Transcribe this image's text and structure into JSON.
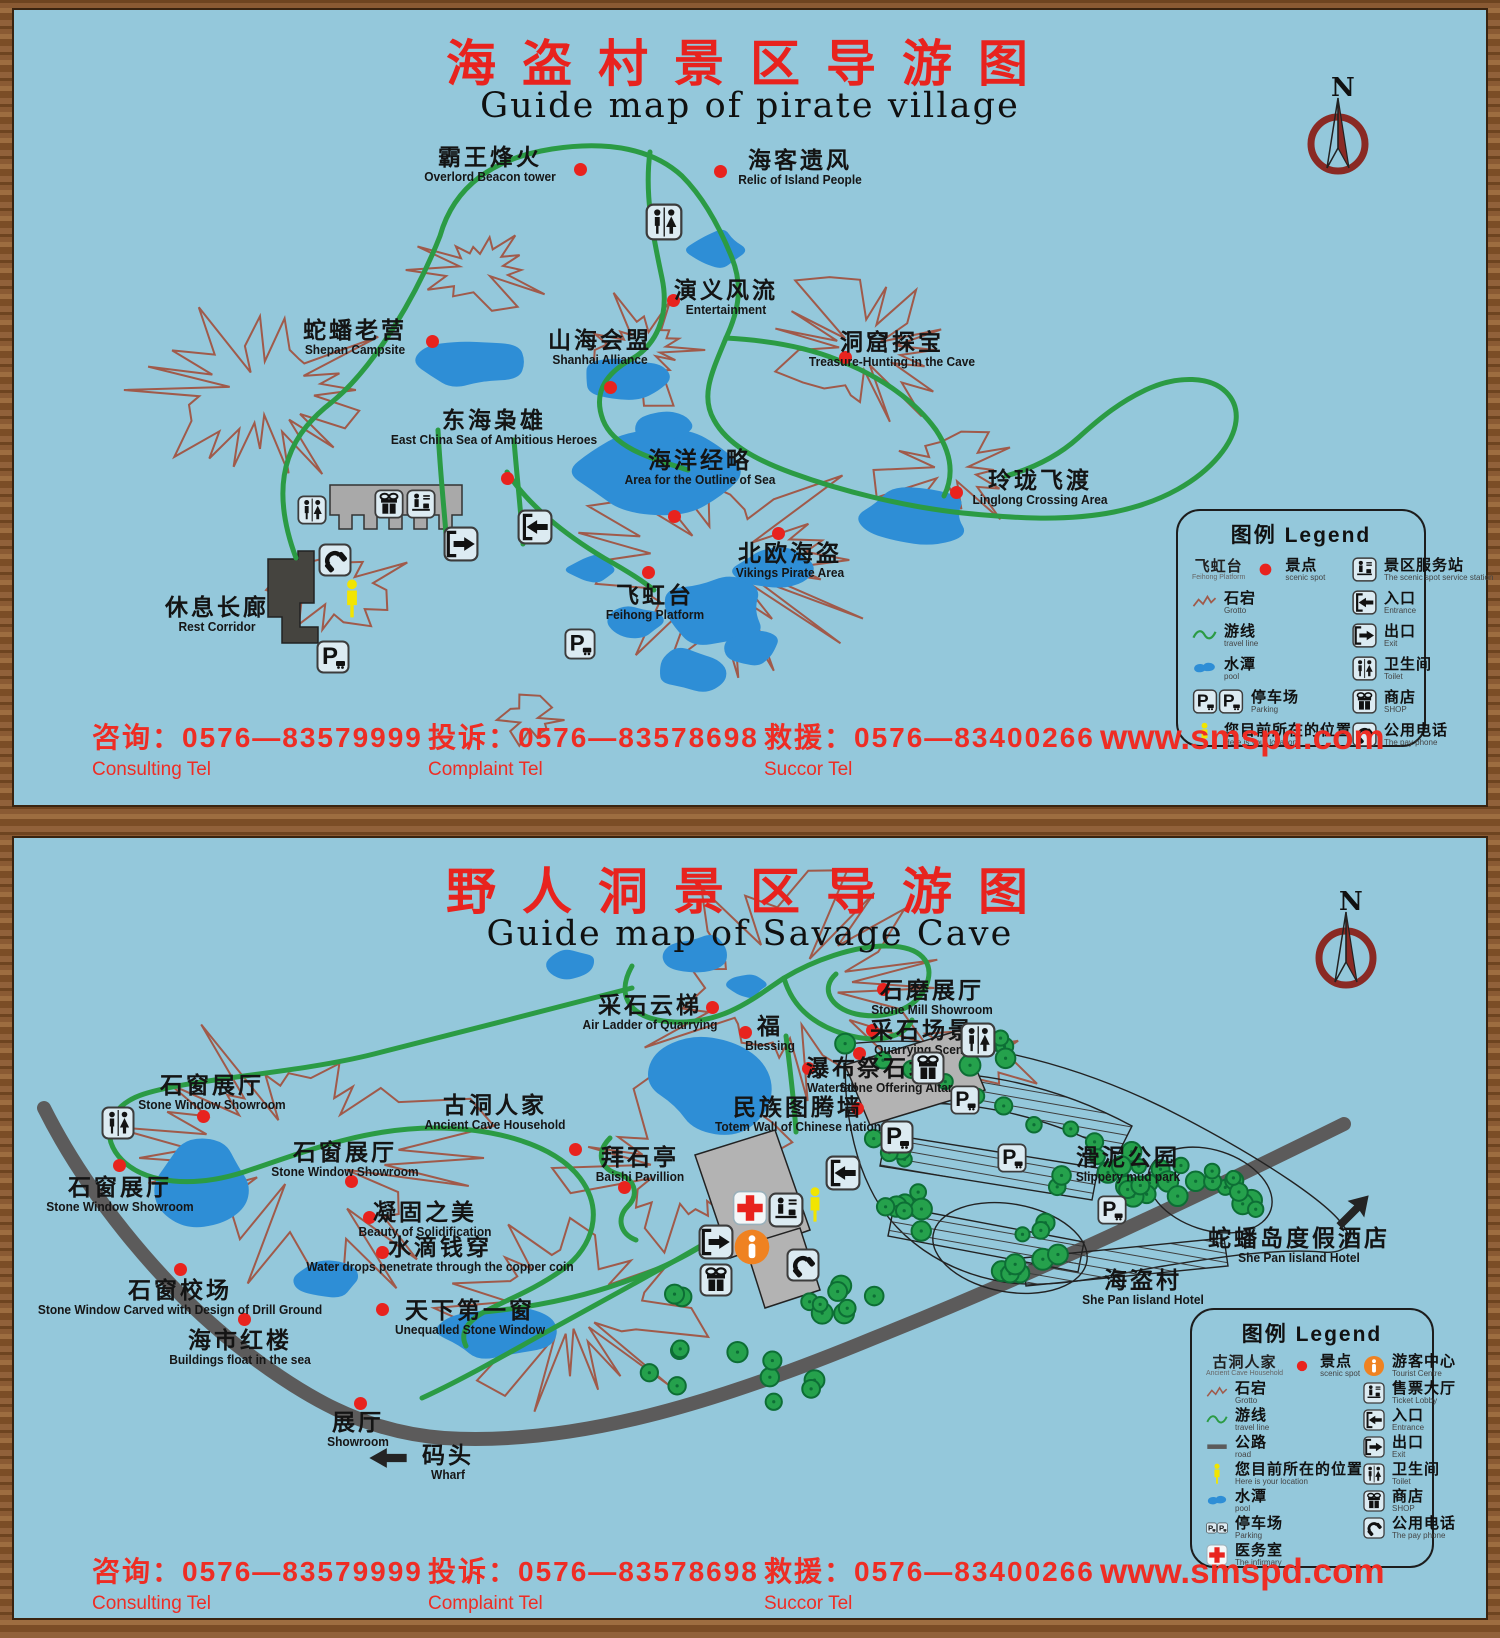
{
  "shared": {
    "compass_label": "N",
    "legend_title": "图例 Legend",
    "website": "www.smspd.com",
    "footer": {
      "consulting_cn": "咨询：0576—83579999",
      "consulting_en": "Consulting Tel",
      "complaint_cn": "投诉：0576—83578698",
      "complaint_en": "Complaint Tel",
      "succor_cn": "救援：0576—83400266",
      "succor_en": "Succor Tel"
    }
  },
  "panel1": {
    "title_cn": "海盗村景区导游图",
    "title_en": "Guide map of pirate village",
    "spots": [
      {
        "cn": "霸王烽火",
        "en": "Overlord Beacon tower",
        "x": 476,
        "y": 135,
        "dot": [
          566,
          159
        ]
      },
      {
        "cn": "海客遗风",
        "en": "Relic of Island People",
        "x": 786,
        "y": 138,
        "dot": [
          706,
          161
        ]
      },
      {
        "cn": "演义风流",
        "en": "Entertainment",
        "x": 712,
        "y": 268,
        "dot": [
          659,
          290
        ]
      },
      {
        "cn": "蛇蟠老营",
        "en": "Shepan Campsite",
        "x": 341,
        "y": 308,
        "dot": [
          418,
          331
        ]
      },
      {
        "cn": "山海会盟",
        "en": "Shanhai Alliance",
        "x": 586,
        "y": 318,
        "dot": [
          596,
          377
        ]
      },
      {
        "cn": "洞窟探宝",
        "en": "Treasure-Hunting in the Cave",
        "x": 878,
        "y": 320,
        "dot": [
          831,
          347
        ]
      },
      {
        "cn": "东海枭雄",
        "en": "East China Sea of Ambitious Heroes",
        "x": 480,
        "y": 398,
        "dot": [
          493,
          468
        ]
      },
      {
        "cn": "海洋经略",
        "en": "Area for the Outline of Sea",
        "x": 686,
        "y": 438,
        "dot": [
          660,
          506
        ]
      },
      {
        "cn": "北欧海盗",
        "en": "Vikings Pirate Area",
        "x": 776,
        "y": 531,
        "dot": [
          764,
          523
        ]
      },
      {
        "cn": "玲珑飞渡",
        "en": "Linglong Crossing Area",
        "x": 1026,
        "y": 458,
        "dot": [
          942,
          482
        ]
      },
      {
        "cn": "飞虹台",
        "en": "Feihong Platform",
        "x": 641,
        "y": 573,
        "dot": [
          634,
          562
        ]
      },
      {
        "cn": "休息长廊",
        "en": "Rest Corridor",
        "x": 203,
        "y": 585,
        "dot": null
      }
    ],
    "map_icons": [
      {
        "icon": "toilet",
        "x": 650,
        "y": 212,
        "s": 38
      },
      {
        "icon": "toilet",
        "x": 298,
        "y": 500,
        "s": 30
      },
      {
        "icon": "shop",
        "x": 375,
        "y": 494,
        "s": 30
      },
      {
        "icon": "service-station",
        "x": 407,
        "y": 494,
        "s": 30
      },
      {
        "icon": "phone",
        "x": 321,
        "y": 550,
        "s": 34
      },
      {
        "icon": "location",
        "x": 338,
        "y": 589,
        "s": 22,
        "h": 42
      },
      {
        "icon": "parking",
        "x": 319,
        "y": 647,
        "s": 34
      },
      {
        "icon": "parking",
        "x": 566,
        "y": 634,
        "s": 32
      },
      {
        "icon": "exit",
        "x": 447,
        "y": 534,
        "s": 36
      },
      {
        "icon": "entrance",
        "x": 521,
        "y": 517,
        "s": 36
      }
    ],
    "legend": {
      "left": [
        {
          "icon": "scenic-spot",
          "cn": "景点",
          "en": "scenic spot",
          "sample_cn": "飞虹台",
          "sample_en": "Feihong Platform"
        },
        {
          "icon": "grotto-line",
          "cn": "石宕",
          "en": "Grotto"
        },
        {
          "icon": "travel-line",
          "cn": "游线",
          "en": "travel line"
        },
        {
          "icon": "pool",
          "cn": "水潭",
          "en": "pool"
        },
        {
          "icon": "parking",
          "cn": "停车场",
          "en": "Parking",
          "double": true
        },
        {
          "icon": "location",
          "cn": "您目前所在的位置",
          "en": "Here is your location"
        }
      ],
      "right": [
        {
          "icon": "service-station",
          "cn": "景区服务站",
          "en": "The scenic spot service station"
        },
        {
          "icon": "entrance",
          "cn": "入口",
          "en": "Entrance"
        },
        {
          "icon": "exit",
          "cn": "出口",
          "en": "Exit"
        },
        {
          "icon": "toilet",
          "cn": "卫生间",
          "en": "Toilet"
        },
        {
          "icon": "shop",
          "cn": "商店",
          "en": "SHOP"
        },
        {
          "icon": "phone",
          "cn": "公用电话",
          "en": "The pay phone"
        }
      ]
    }
  },
  "panel2": {
    "title_cn": "野人洞景区导游图",
    "title_en": "Guide map of Savage Cave",
    "spots": [
      {
        "cn": "采石云梯",
        "en": "Air Ladder of Quarrying",
        "x": 636,
        "y": 155,
        "dot": [
          698,
          169
        ]
      },
      {
        "cn": "福",
        "en": "Blessing",
        "x": 756,
        "y": 176,
        "dot": [
          731,
          194
        ]
      },
      {
        "cn": "石磨展厅",
        "en": "Stone Mill Showroom",
        "x": 918,
        "y": 140,
        "dot": [
          869,
          151
        ]
      },
      {
        "cn": "采石场景",
        "en": "Quarrying Scene",
        "x": 908,
        "y": 180,
        "dot": [
          858,
          192
        ]
      },
      {
        "cn": "瀑布",
        "en": "Waterfall",
        "x": 818,
        "y": 218,
        "dot": [
          794,
          230
        ]
      },
      {
        "cn": "祭石坛",
        "en": "Stone Offering Altar",
        "x": 882,
        "y": 218,
        "dot": [
          845,
          215
        ]
      },
      {
        "cn": "民族图腾墙",
        "en": "Totem Wall of Chinese nation",
        "x": 784,
        "y": 257,
        "dot": [
          843,
          270
        ]
      },
      {
        "cn": "古洞人家",
        "en": "Ancient Cave Household",
        "x": 481,
        "y": 255,
        "dot": [
          561,
          311
        ]
      },
      {
        "cn": "拜石亭",
        "en": "Baishi Pavillion",
        "x": 626,
        "y": 307,
        "dot": [
          610,
          349
        ]
      },
      {
        "cn": "石窗展厅",
        "en": "Stone Window Showroom",
        "x": 198,
        "y": 235,
        "dot": [
          189,
          278
        ]
      },
      {
        "cn": "石窗展厅",
        "en": "Stone Window Showroom",
        "x": 331,
        "y": 302,
        "dot": [
          337,
          343
        ]
      },
      {
        "cn": "石窗展厅",
        "en": "Stone Window Showroom",
        "x": 106,
        "y": 337,
        "dot": [
          105,
          327
        ]
      },
      {
        "cn": "凝固之美",
        "en": "Beauty of Solidification",
        "x": 411,
        "y": 362,
        "dot": [
          355,
          379
        ]
      },
      {
        "cn": "水滴钱穿",
        "en": "Water drops penetrate through the copper coin",
        "x": 426,
        "y": 397,
        "dot": [
          368,
          414
        ]
      },
      {
        "cn": "石窗校场",
        "en": "Stone Window Carved with Design of Drill Ground",
        "x": 166,
        "y": 440,
        "dot": [
          166,
          431
        ]
      },
      {
        "cn": "海市红楼",
        "en": "Buildings float in the sea",
        "x": 226,
        "y": 490,
        "dot": [
          230,
          481
        ]
      },
      {
        "cn": "天下第一窗",
        "en": "Unequalled Stone Window",
        "x": 456,
        "y": 460,
        "dot": [
          368,
          471
        ]
      },
      {
        "cn": "展厅",
        "en": "Showroom",
        "x": 344,
        "y": 572,
        "dot": [
          346,
          565
        ]
      },
      {
        "cn": "码头",
        "en": "Wharf",
        "x": 434,
        "y": 605,
        "dot": null
      },
      {
        "cn": "滑泥公园",
        "en": "Slippery mud park",
        "x": 1114,
        "y": 307,
        "dot": null
      },
      {
        "cn": "蛇蟠岛度假酒店",
        "en": "She Pan Iisland Hotel",
        "x": 1285,
        "y": 388,
        "dot": null
      },
      {
        "cn": "海盗村",
        "en": "She Pan Iisland Hotel",
        "x": 1129,
        "y": 430,
        "dot": null
      }
    ],
    "map_icons": [
      {
        "icon": "toilet",
        "x": 964,
        "y": 202,
        "s": 36
      },
      {
        "icon": "toilet",
        "x": 104,
        "y": 285,
        "s": 34
      },
      {
        "icon": "shop",
        "x": 914,
        "y": 230,
        "s": 34
      },
      {
        "icon": "entrance",
        "x": 829,
        "y": 335,
        "s": 36
      },
      {
        "icon": "infirmary",
        "x": 736,
        "y": 370,
        "s": 36
      },
      {
        "icon": "service-station",
        "x": 772,
        "y": 372,
        "s": 36
      },
      {
        "icon": "location",
        "x": 801,
        "y": 367,
        "s": 20,
        "h": 40
      },
      {
        "icon": "exit",
        "x": 702,
        "y": 404,
        "s": 36
      },
      {
        "icon": "tourist-centre",
        "x": 738,
        "y": 409,
        "s": 38
      },
      {
        "icon": "shop",
        "x": 702,
        "y": 442,
        "s": 34
      },
      {
        "icon": "phone",
        "x": 789,
        "y": 427,
        "s": 34
      },
      {
        "icon": "parking",
        "x": 883,
        "y": 299,
        "s": 34
      },
      {
        "icon": "parking",
        "x": 951,
        "y": 262,
        "s": 30
      },
      {
        "icon": "parking",
        "x": 998,
        "y": 320,
        "s": 30
      },
      {
        "icon": "parking",
        "x": 1098,
        "y": 372,
        "s": 30
      },
      {
        "icon": "arrow-ne",
        "x": 1338,
        "y": 374,
        "s": 40
      },
      {
        "icon": "arrow-left",
        "x": 374,
        "y": 620,
        "s": 42,
        "h": 26
      }
    ],
    "legend": {
      "left": [
        {
          "icon": "scenic-spot",
          "cn": "景点",
          "en": "scenic spot",
          "sample_cn": "古洞人家",
          "sample_en": "Ancient Cave Household"
        },
        {
          "icon": "grotto-line",
          "cn": "石宕",
          "en": "Grotto"
        },
        {
          "icon": "travel-line",
          "cn": "游线",
          "en": "travel line"
        },
        {
          "icon": "road",
          "cn": "公路",
          "en": "road"
        },
        {
          "icon": "location",
          "cn": "您目前所在的位置",
          "en": "Here is your location"
        },
        {
          "icon": "pool",
          "cn": "水潭",
          "en": "pool"
        },
        {
          "icon": "parking",
          "cn": "停车场",
          "en": "Parking",
          "double": true
        },
        {
          "icon": "infirmary",
          "cn": "医务室",
          "en": "The infirmary"
        }
      ],
      "right": [
        {
          "icon": "tourist-centre",
          "cn": "游客中心",
          "en": "Tourist Centre"
        },
        {
          "icon": "service-station",
          "cn": "售票大厅",
          "en": "Ticket Lobby"
        },
        {
          "icon": "entrance",
          "cn": "入口",
          "en": "Entrance"
        },
        {
          "icon": "exit",
          "cn": "出口",
          "en": "Exit"
        },
        {
          "icon": "toilet",
          "cn": "卫生间",
          "en": "Toilet"
        },
        {
          "icon": "shop",
          "cn": "商店",
          "en": "SHOP"
        },
        {
          "icon": "phone",
          "cn": "公用电话",
          "en": "The pay phone"
        }
      ]
    }
  }
}
